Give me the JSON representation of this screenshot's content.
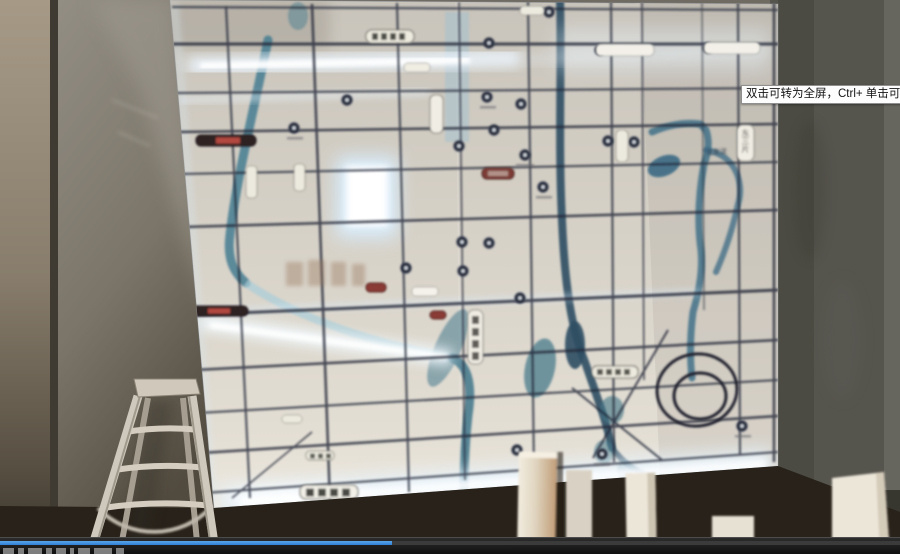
{
  "window": {
    "width": 900,
    "height": 554
  },
  "player": {
    "tooltip_text": "双击可转为全屏，Ctrl+ 单击可转为",
    "progress_percent": 43.5,
    "colors": {
      "progress_blue": "#2f81d8",
      "bar_background": "#161616",
      "track_grey": "#3b3b3b",
      "tooltip_background": "#fdfdfd",
      "tooltip_border": "#8f8f8f"
    }
  },
  "scene": {
    "map_labels": [
      {
        "text": "东三片",
        "orientation": "vertical"
      },
      {
        "text": "沈发淀",
        "orientation": "horizontal"
      }
    ],
    "colors": {
      "map_base": "#d3cec4",
      "road_line": "#232838",
      "river_teal": "#3f758a",
      "river_dark": "#2e4d63",
      "glow_white": "#eaf6ff",
      "wall_left": "#857f74",
      "wall_right": "#55544d",
      "ladder_aluminum": "#c9c2b5",
      "pillar_white": "#ece6da",
      "red_label": "#b24a40"
    }
  }
}
